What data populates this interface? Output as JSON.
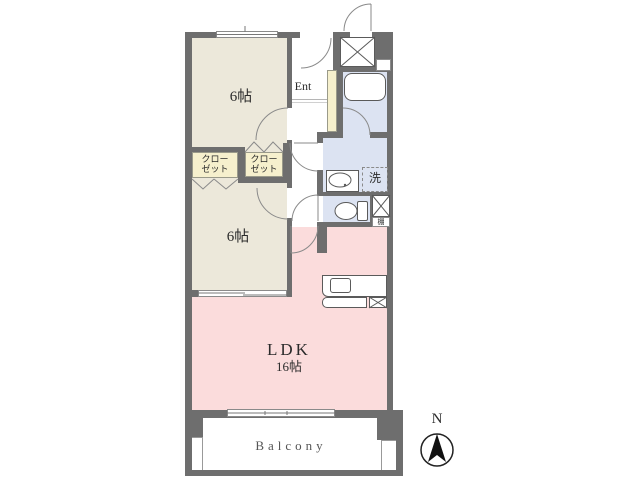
{
  "rooms": {
    "bedroom1": {
      "label": "6帖"
    },
    "bedroom2": {
      "label": "6帖"
    },
    "ldk": {
      "label": "LDK",
      "size": "16帖"
    },
    "entrance": {
      "label": "Ent"
    },
    "closet1": {
      "line1": "クロー",
      "line2": "ゼット"
    },
    "closet2": {
      "line1": "クロー",
      "line2": "ゼット"
    },
    "laundry": {
      "label": "洗"
    },
    "shelf": {
      "label": "棚"
    },
    "balcony": {
      "label": "Balcony"
    }
  },
  "compass": {
    "north": "N"
  },
  "colors": {
    "wall": "#6e6e6e",
    "tatami_room": "#ece8da",
    "closet": "#f6f0cd",
    "wet_area": "#dce3f2",
    "ldk": "#fbdcdc",
    "background": "#ffffff"
  }
}
